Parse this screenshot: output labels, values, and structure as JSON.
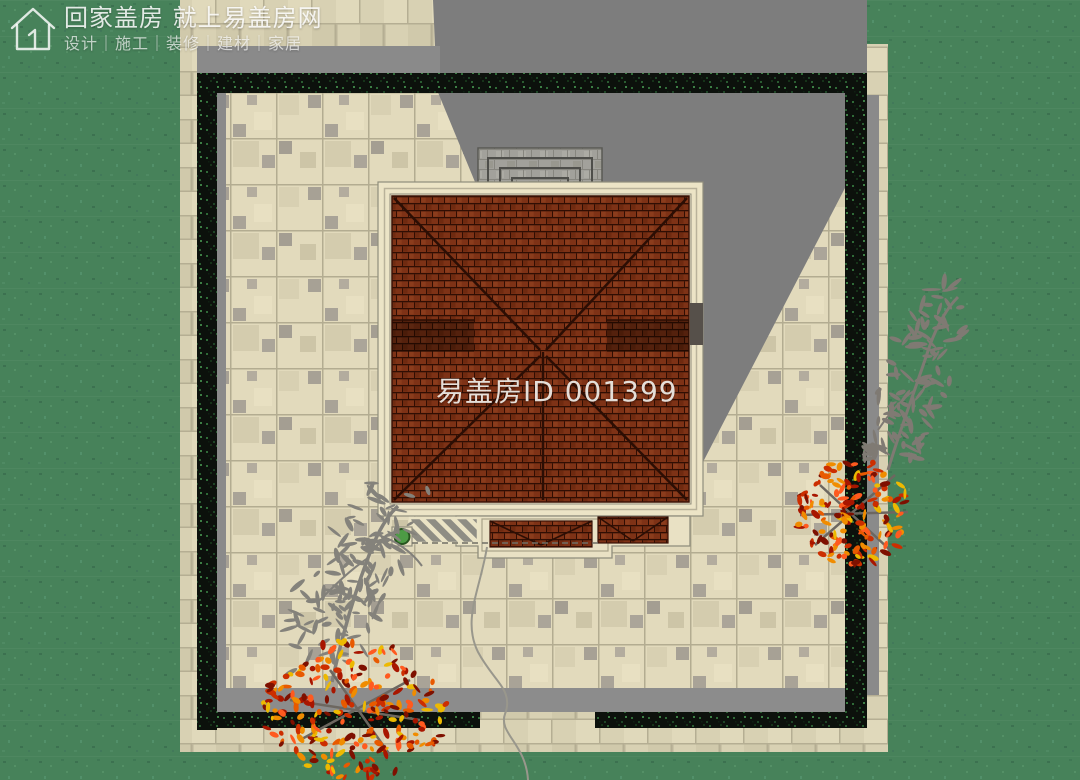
{
  "watermark": {
    "logo_icon": "house-logo-icon",
    "title": "回家盖房 就上易盖房网",
    "subtitle": "设计｜施工｜装修｜建材｜家居"
  },
  "site_plan": {
    "house_id_label": "易盖房ID 001399"
  },
  "colors": {
    "grass": "#47825A",
    "courtyard_paving": "#E2DABC",
    "apron_paving": "#D8D1B3",
    "roof_tile": "#7E3216",
    "roof_trim": "#ECE4C6",
    "hedge": "#0C110C",
    "cast_shadow": "#7D7D7D",
    "autumn_tree": "#D94B00",
    "gray_tree": "#84827B",
    "planter_green": "#4D9B45"
  }
}
